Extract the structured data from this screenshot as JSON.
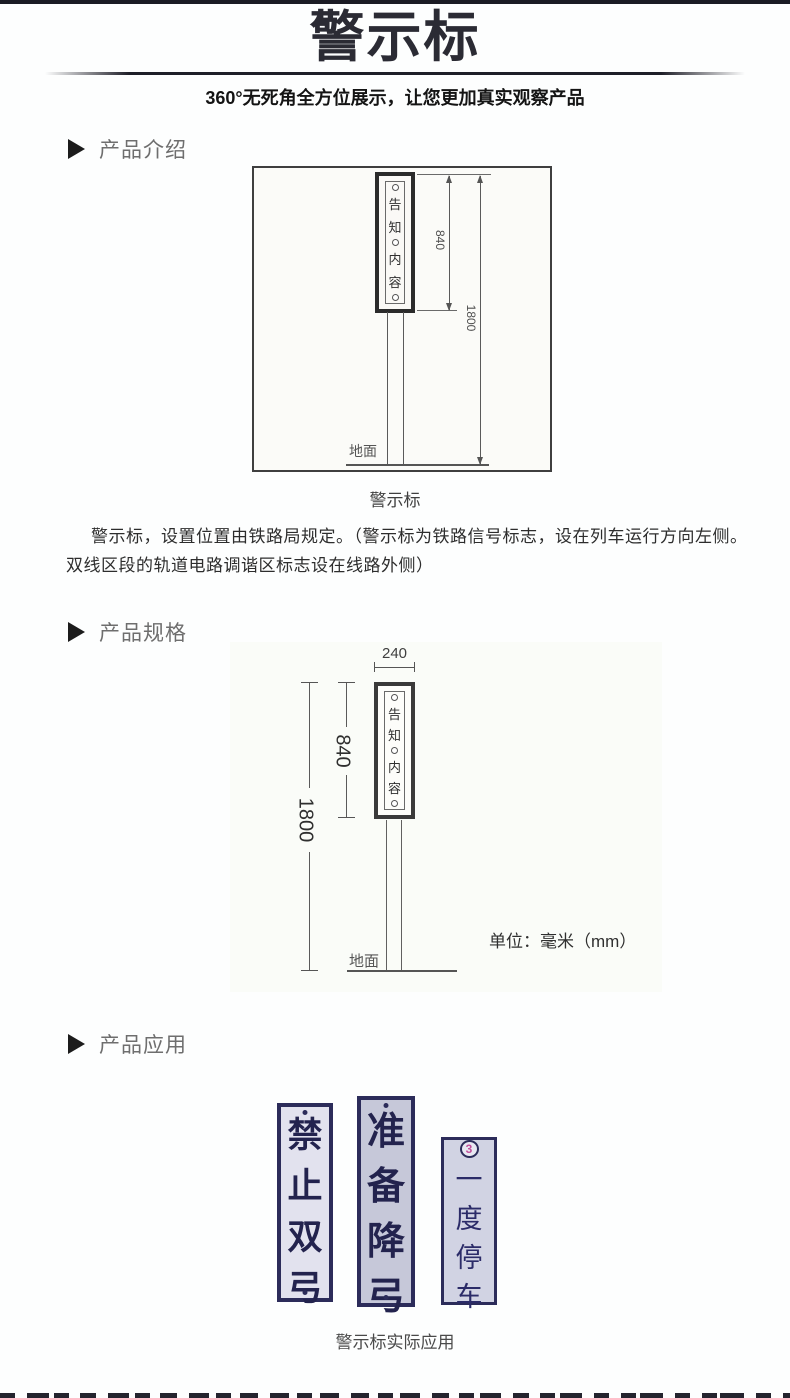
{
  "header": {
    "title": "警示标",
    "subtitle": "360°无死角全方位展示，让您更加真实观察产品"
  },
  "sections": {
    "intro_label": "产品介绍",
    "spec_label": "产品规格",
    "app_label": "产品应用"
  },
  "intro": {
    "diagram": {
      "sign_chars": [
        "告",
        "知",
        "内",
        "容"
      ],
      "dim_sign_height": "840",
      "dim_total_height": "1800",
      "ground_label": "地面"
    },
    "caption": "警示标",
    "description": "警示标，设置位置由铁路局规定。（警示标为铁路信号标志，设在列车运行方向左侧。双线区段的轨道电路调谐区标志设在线路外侧）"
  },
  "spec": {
    "diagram": {
      "sign_chars": [
        "告",
        "知",
        "内",
        "容"
      ],
      "dim_width": "240",
      "dim_sign_height": "840",
      "dim_total_height": "1800",
      "ground_label": "地面",
      "unit_note": "单位：毫米（mm）"
    }
  },
  "app": {
    "signs": [
      {
        "label": "禁止双弓",
        "chars": [
          "禁",
          "止",
          "双",
          "弓"
        ]
      },
      {
        "label": "准备降弓",
        "chars": [
          "准",
          "备",
          "降",
          "弓"
        ]
      },
      {
        "label": "一度停车",
        "chars": [
          "一",
          "度",
          "停",
          "车"
        ],
        "badge": "3"
      }
    ],
    "caption": "警示标实际应用"
  },
  "colors": {
    "accent_dark": "#2b2b34",
    "sign_navy": "#2c2c5a",
    "badge_pink": "#c2509c",
    "diagram_stroke": "#555555"
  }
}
